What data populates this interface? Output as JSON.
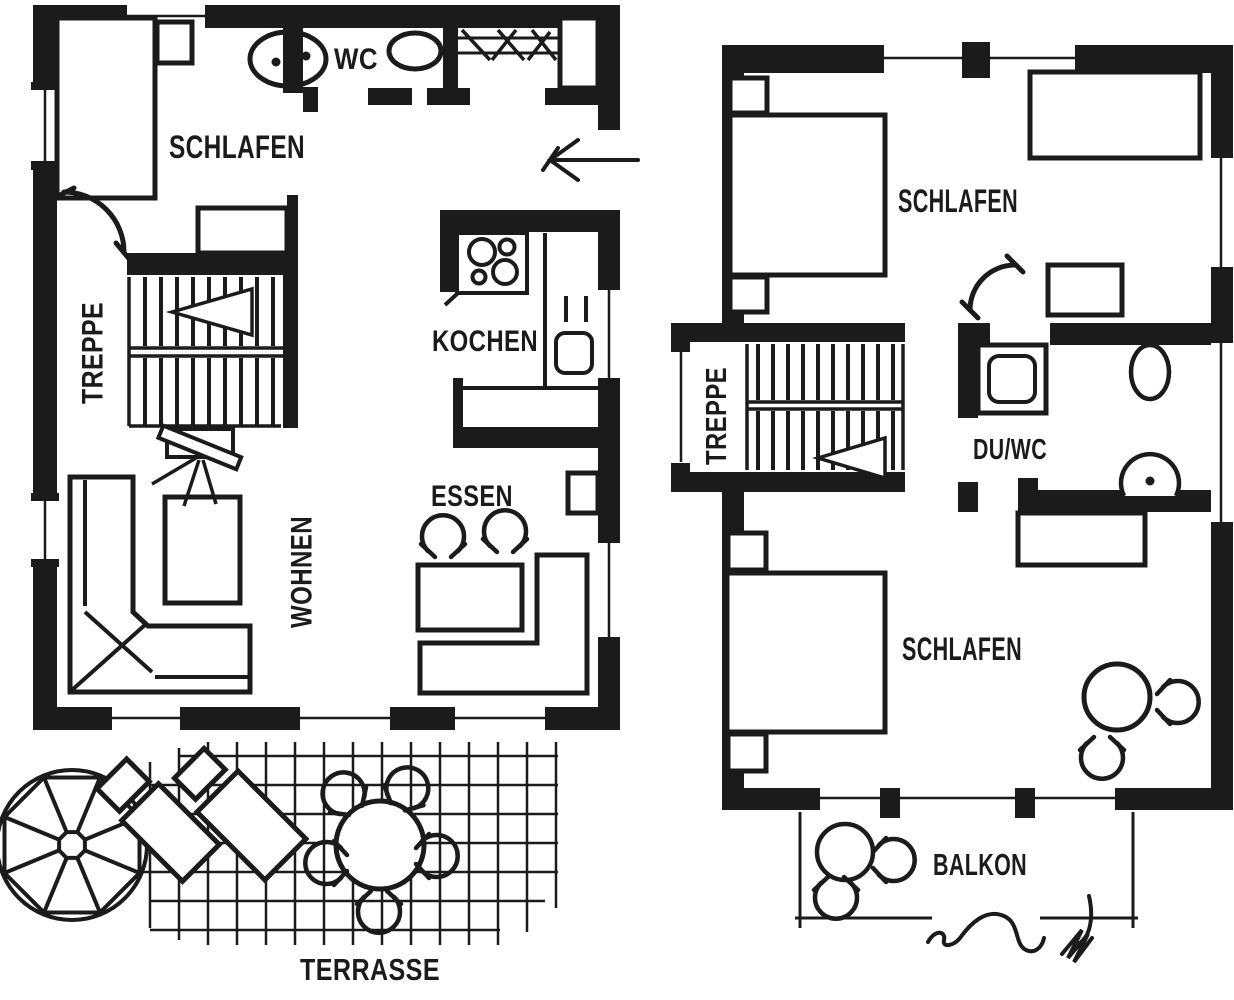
{
  "meta": {
    "ink_color": "#1b1b1b",
    "background_color": "#ffffff",
    "drawing_type": "floor-plan"
  },
  "ground_floor": {
    "rooms": {
      "schlafen": "SCHLAFEN",
      "wc": "WC",
      "treppe": "TREPPE",
      "kochen": "KOCHEN",
      "essen": "ESSEN",
      "wohnen": "WOHNEN",
      "terrasse": "TERRASSE"
    }
  },
  "upper_floor": {
    "rooms": {
      "schlafen_1": "SCHLAFEN",
      "treppe": "TREPPE",
      "du_wc": "DU/WC",
      "schlafen_2": "SCHLAFEN",
      "balkon": "BALKON"
    }
  }
}
